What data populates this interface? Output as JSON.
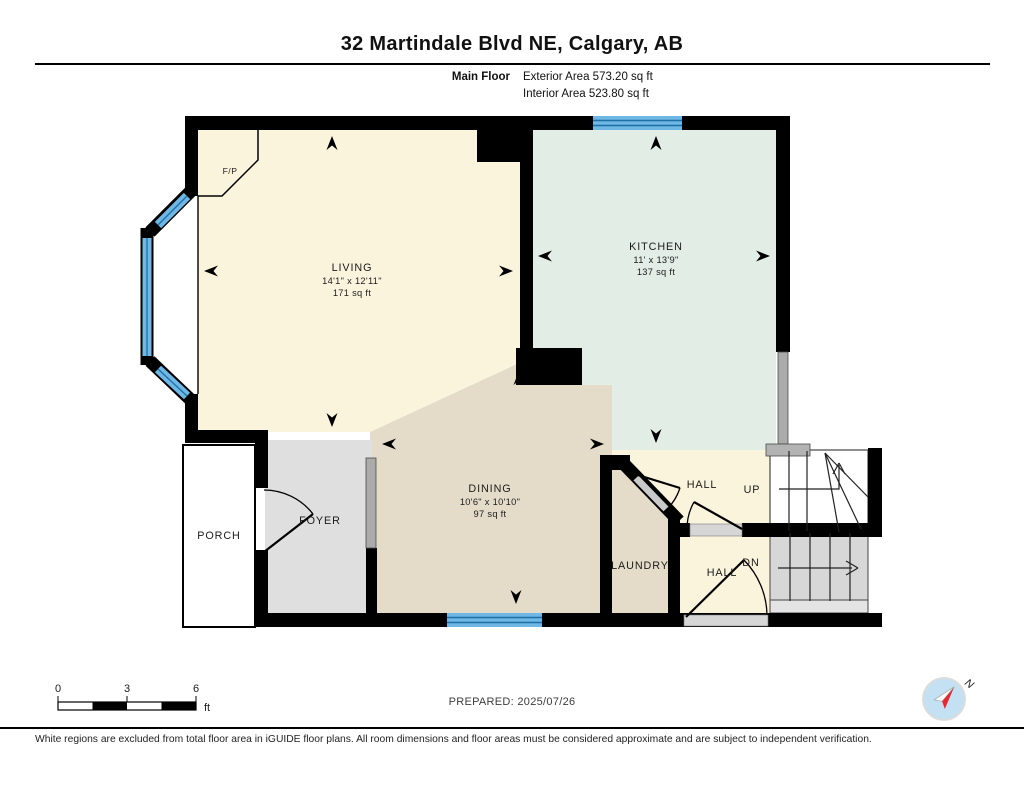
{
  "header": {
    "title": "32 Martindale Blvd NE, Calgary, AB",
    "floor_label": "Main Floor",
    "exterior_area": "Exterior Area 573.20 sq ft",
    "interior_area": "Interior Area 523.80 sq ft"
  },
  "rooms": {
    "living": {
      "name": "LIVING",
      "dims": "14'1\" x 12'11\"",
      "area": "171 sq ft"
    },
    "kitchen": {
      "name": "KITCHEN",
      "dims": "11' x 13'9\"",
      "area": "137 sq ft"
    },
    "dining": {
      "name": "DINING",
      "dims": "10'6\" x 10'10\"",
      "area": "97 sq ft"
    },
    "foyer": {
      "name": "FOYER"
    },
    "porch": {
      "name": "PORCH"
    },
    "laundry": {
      "name": "LAUNDRY"
    },
    "hall_upper": {
      "name": "HALL"
    },
    "hall_lower": {
      "name": "HALL"
    },
    "stairs_up_label": "UP",
    "stairs_down_label": "DN",
    "fireplace_label": "F/P"
  },
  "scale_bar": {
    "ticks": [
      "0",
      "3",
      "6"
    ],
    "unit": "ft"
  },
  "prepared_label": "PREPARED: 2025/07/26",
  "compass": {
    "north_label": "N"
  },
  "footer": {
    "disclaimer": "White regions are excluded from total floor area in iGUIDE floor plans. All room dimensions and floor areas must be considered approximate and are subject to independent verification."
  },
  "colors": {
    "wall": "#000000",
    "living_fill": "#FBF4DD",
    "kitchen_fill": "#E2EDE6",
    "dining_fill": "#E4DCC9",
    "foyer_fill": "#DFDFDF",
    "stair_fill": "#D7D7D7",
    "window_blue": "#6FB7E4",
    "window_line": "#1D6FA6",
    "compass_red": "#E8262C",
    "compass_blue": "#C3E1F2"
  }
}
